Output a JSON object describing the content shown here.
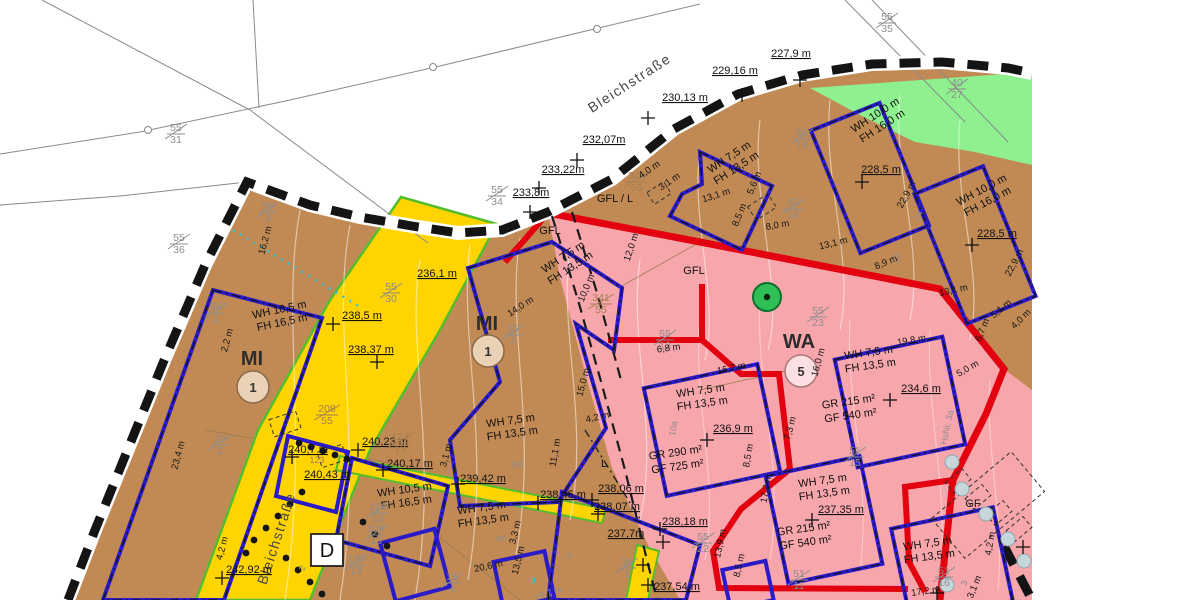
{
  "colors": {
    "brown": "#c18a55",
    "pink": "#f7a6ac",
    "yellow": "#ffd400",
    "green_area": "#8ef08e",
    "strip_green": "#54bd2e",
    "red": "#e3000f",
    "blue": "#2a1ac8",
    "boundary": "#141414"
  },
  "streets": [
    {
      "t": "Bleichstraße"
    },
    {
      "t": "Bleichstraße"
    }
  ],
  "zones": [
    {
      "code": "MI",
      "num": "1"
    },
    {
      "code": "MI",
      "num": "1"
    },
    {
      "code": "WA",
      "num": "5"
    }
  ],
  "annot": {
    "d_box": "D",
    "hsnr": "HsNr. 3a",
    "gfl_l": "GFL / L",
    "gfl1": "GFL",
    "gfl2": "GFL",
    "gf": "GF",
    "l": "L"
  },
  "elevations": [
    {
      "t": "227,9 m"
    },
    {
      "t": "229,16 m"
    },
    {
      "t": "230,13 m"
    },
    {
      "t": "232,07m"
    },
    {
      "t": "233,22m"
    },
    {
      "t": "233,8m"
    },
    {
      "t": "236,1 m"
    },
    {
      "t": "238,5 m"
    },
    {
      "t": "238,37 m"
    },
    {
      "t": "240,7 m"
    },
    {
      "t": "240,23 m"
    },
    {
      "t": "240,17 m"
    },
    {
      "t": "240,43 m"
    },
    {
      "t": "239,42 m"
    },
    {
      "t": "238,45 m"
    },
    {
      "t": "238,06 m"
    },
    {
      "t": "238,07 m"
    },
    {
      "t": "238,18 m"
    },
    {
      "t": "237,7m"
    },
    {
      "t": "237,54 m"
    },
    {
      "t": "242,92 m"
    },
    {
      "t": "228,5 m"
    },
    {
      "t": "228,5 m"
    },
    {
      "t": "234,6 m"
    },
    {
      "t": "236,9 m"
    },
    {
      "t": "237,35 m"
    }
  ],
  "parcels": [
    {
      "n": "55",
      "d": "35"
    },
    {
      "n": "40",
      "d": "27"
    },
    {
      "n": "55",
      "d": "31"
    },
    {
      "n": "55",
      "d": "36"
    },
    {
      "n": "55",
      "d": "34"
    },
    {
      "n": "55",
      "d": "18"
    },
    {
      "n": "55",
      "d": "16"
    },
    {
      "n": "348",
      "d": "55"
    },
    {
      "n": "341",
      "d": "55"
    },
    {
      "n": "55",
      "d": "30"
    },
    {
      "n": "56",
      "d": "3"
    },
    {
      "n": "56",
      "d": "1"
    },
    {
      "n": "10",
      "d": "2"
    },
    {
      "n": "208",
      "d": "55"
    },
    {
      "n": "123",
      "d": "13"
    },
    {
      "n": "126",
      "d": "13"
    },
    {
      "n": "129",
      "d": "13"
    },
    {
      "n": "130",
      "d": "13"
    },
    {
      "n": "15",
      "d": "4"
    },
    {
      "n": "16",
      "d": "1"
    },
    {
      "n": "55",
      "d": "2"
    },
    {
      "n": "55",
      "d": "13"
    },
    {
      "n": "55",
      "d": "23"
    },
    {
      "n": "55",
      "d": "22"
    },
    {
      "n": "51",
      "d": "15"
    },
    {
      "n": "51",
      "d": "11"
    },
    {
      "n": "51",
      "d": "16"
    }
  ],
  "dims": [
    {
      "t": "4,0 m"
    },
    {
      "t": "3,1 m"
    },
    {
      "t": "13,1 m"
    },
    {
      "t": "5,6 m"
    },
    {
      "t": "8,5 m"
    },
    {
      "t": "8,0 m"
    },
    {
      "t": "13,1 m"
    },
    {
      "t": "8,9 m"
    },
    {
      "t": "22,9 m"
    },
    {
      "t": "22,9 m"
    },
    {
      "t": "13,1 m"
    },
    {
      "t": "5,1 m"
    },
    {
      "t": "12,0 m"
    },
    {
      "t": "14,0 m"
    },
    {
      "t": "10,0 m"
    },
    {
      "t": "15,0 m"
    },
    {
      "t": "4,2 m"
    },
    {
      "t": "11,1 m"
    },
    {
      "t": "3,1 m"
    },
    {
      "t": "16,2 m"
    },
    {
      "t": "2,2 m"
    },
    {
      "t": "23,4 m"
    },
    {
      "t": "4,2 m"
    },
    {
      "t": "16,7 m"
    },
    {
      "t": "16,0 m"
    },
    {
      "t": "7,3 m"
    },
    {
      "t": "6,8 m"
    },
    {
      "t": "19,8 m"
    },
    {
      "t": "5,0 m"
    },
    {
      "t": "6,7 m"
    },
    {
      "t": "17,2 m"
    },
    {
      "t": "8,5 m"
    },
    {
      "t": "13,9 m"
    },
    {
      "t": "8,5 m"
    },
    {
      "t": "17,2 m"
    },
    {
      "t": "3,1 m"
    },
    {
      "t": "4,2 m"
    },
    {
      "t": "20,6 m"
    },
    {
      "t": "13,5 m"
    },
    {
      "t": "3,3 m"
    },
    {
      "t": "4,0 m"
    }
  ],
  "rules": [
    {
      "l1": "WH 10,0 m",
      "l2": "FH 16,0 m"
    },
    {
      "l1": "WH 10,0 m",
      "l2": "FH 16,0 m"
    },
    {
      "l1": "WH 7,5 m",
      "l2": "FH 13,5 m"
    },
    {
      "l1": "WH 7,5 m",
      "l2": "FH 13,5 m"
    },
    {
      "l1": "WH 7,5 m",
      "l2": "FH 13,5 m"
    },
    {
      "l1": "WH 10,5 m",
      "l2": "FH 16,5 m"
    },
    {
      "l1": "WH 10,5 m",
      "l2": "FH 16,5 m"
    },
    {
      "l1": "WH 7,5 m",
      "l2": "FH 13,5 m"
    },
    {
      "l1": "WH 7,5 m",
      "l2": "FH 13,5 m"
    },
    {
      "l1": "WH 7,5 m",
      "l2": "FH 13,5 m"
    },
    {
      "l1": "WH 7,5 m",
      "l2": "FH 13,5 m"
    },
    {
      "l1": "WH 7,5 m",
      "l2": "FH 13,5 m"
    }
  ],
  "areas": [
    {
      "l1": "GR 290 m²",
      "l2": "GF 725 m²"
    },
    {
      "l1": "GR 215 m²",
      "l2": "GF 540 m²"
    },
    {
      "l1": "GR 215 m²",
      "l2": "GF 540 m²"
    }
  ],
  "small_ids": [
    {
      "t": "123"
    },
    {
      "t": "8a"
    },
    {
      "t": "4a"
    },
    {
      "t": "10a"
    },
    {
      "t": "6"
    },
    {
      "t": "14"
    },
    {
      "t": "12"
    },
    {
      "t": "2"
    },
    {
      "t": "3"
    },
    {
      "t": "9"
    },
    {
      "t": "10,7 m"
    }
  ]
}
